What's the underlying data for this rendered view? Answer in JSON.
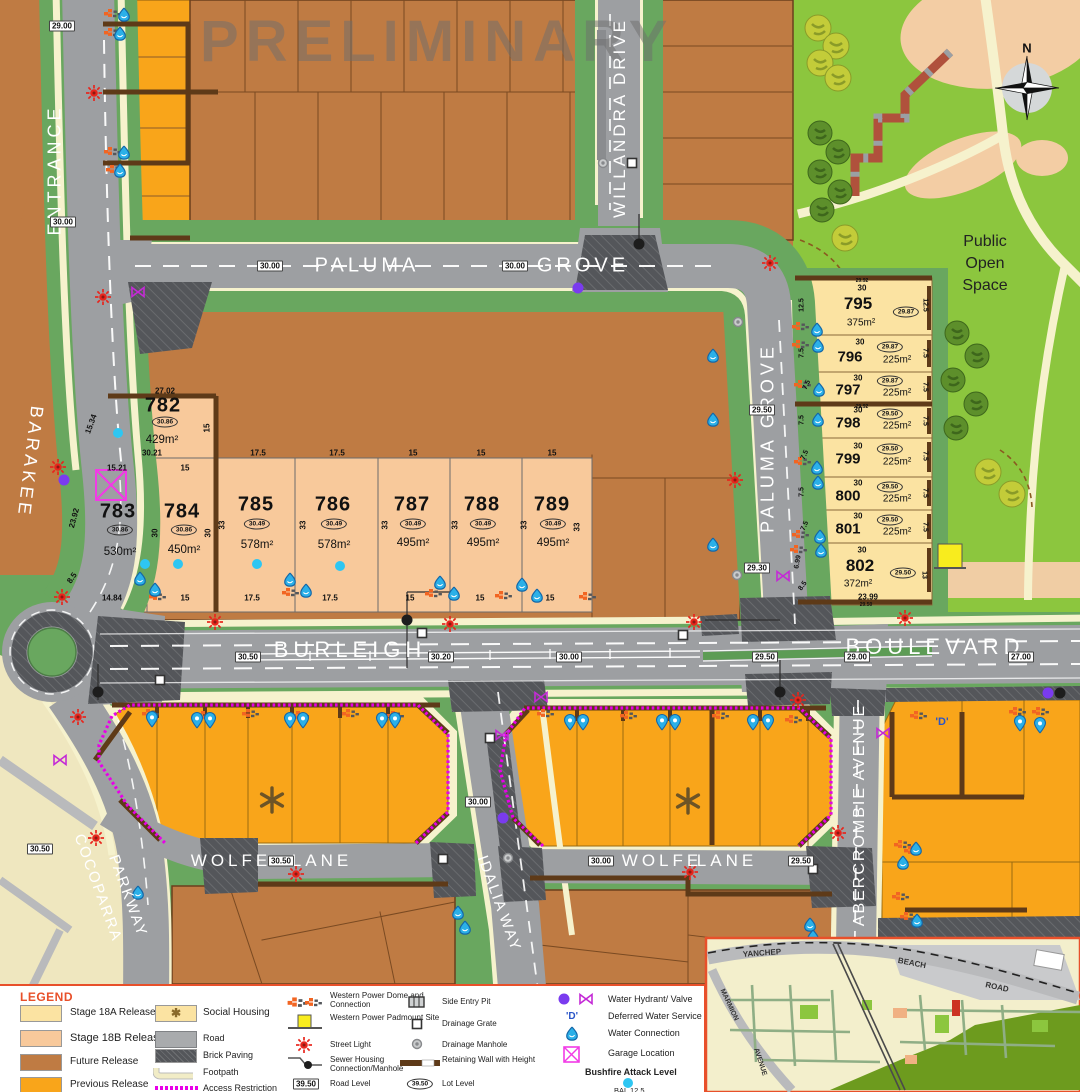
{
  "watermark": "PRELIMINARY",
  "map_labels": {
    "pos1": "Public",
    "pos2": "Open",
    "pos3": "Space",
    "north": "N",
    "deferred": "'D'"
  },
  "streets": {
    "entrance": "ENTRANCE",
    "barakee": "BARAKEE",
    "willandra": "WILLANDRA  DRIVE",
    "paluma_top": "PALUMA",
    "grove_top": "GROVE",
    "paluma_right": "PALUMA  GROVE",
    "burleigh": "BURLEIGH",
    "boulevard": "BOULEVARD",
    "wolfe_w1": "WOLFE",
    "wolfe_w2": "LANE",
    "wolfe_e1": "WOLFE",
    "wolfe_e2": "LANE",
    "idalia1": "IDALIA",
    "idalia2": "WAY",
    "abercrombie": "ABERCROMBIE  AVENUE",
    "cocoparra1": "COCOPARRA",
    "cocoparra2": "PARKWAY"
  },
  "road_levels": {
    "rl1": "29.00",
    "rl2": "30.00",
    "rl3": "30.00",
    "rl4": "30.00",
    "rl5": "29.50",
    "rl6": "29.30",
    "rl7": "30.50",
    "rl8": "30.20",
    "rl9": "30.00",
    "rl10": "29.50",
    "rl11": "29.00",
    "rl12": "27.00",
    "rl13": "30.50",
    "rl14": "30.50",
    "rl15": "30.00",
    "rl16": "29.50",
    "rl17": "30.00"
  },
  "wall_levels": {
    "a": "29.92",
    "b": "29.92",
    "c": "29.50"
  },
  "lots_18b": [
    {
      "num": "782",
      "level": "30.86",
      "area": "429m²",
      "top": "27.02",
      "left": "15.34",
      "right": "15",
      "bottom": "30.21"
    },
    {
      "num": "783",
      "level": "30.86",
      "area": "530m²",
      "top": "15.21",
      "left": "23.92",
      "left2": "8.5",
      "bottom": "14.84",
      "side": "30"
    },
    {
      "num": "784",
      "level": "30.86",
      "area": "450m²",
      "top": "15",
      "side": "30",
      "bottom": "15"
    },
    {
      "num": "785",
      "level": "30.49",
      "area": "578m²",
      "top": "17.5",
      "side": "33",
      "bottom": "17.5"
    },
    {
      "num": "786",
      "level": "30.49",
      "area": "578m²",
      "top": "17.5",
      "side": "33",
      "bottom": "17.5"
    },
    {
      "num": "787",
      "level": "30.49",
      "area": "495m²",
      "top": "15",
      "side": "33",
      "bottom": "15"
    },
    {
      "num": "788",
      "level": "30.49",
      "area": "495m²",
      "top": "15",
      "side": "33",
      "bottom": "15"
    },
    {
      "num": "789",
      "level": "30.49",
      "area": "495m²",
      "top": "15",
      "side": "33",
      "bottom": "15"
    }
  ],
  "lots_18a": [
    {
      "num": "795",
      "level": "29.87",
      "area": "375m²",
      "top": "30",
      "side": "12.5"
    },
    {
      "num": "796",
      "level": "29.87",
      "area": "225m²",
      "top": "30",
      "side": "7.5"
    },
    {
      "num": "797",
      "level": "29.87",
      "area": "225m²",
      "top": "30",
      "side": "7.5"
    },
    {
      "num": "798",
      "level": "29.50",
      "area": "225m²",
      "top": "30",
      "side": "7.5"
    },
    {
      "num": "799",
      "level": "29.50",
      "area": "225m²",
      "top": "30",
      "side": "7.5"
    },
    {
      "num": "800",
      "level": "29.50",
      "area": "225m²",
      "top": "30",
      "side": "7.5"
    },
    {
      "num": "801",
      "level": "29.50",
      "area": "225m²",
      "top": "30",
      "side": "7.5"
    },
    {
      "num": "802",
      "level": "29.50",
      "area": "372m²",
      "top": "30",
      "left": "6.99",
      "left2": "8.5",
      "right": "13",
      "bottom": "23.99"
    }
  ],
  "legend": {
    "title": "LEGEND",
    "releases": [
      {
        "label": "Stage 18A Release",
        "color": "#fbe3a2"
      },
      {
        "label": "Stage 18B Release",
        "color": "#f8c99b"
      },
      {
        "label": "Future Release",
        "color": "#bf7b43"
      },
      {
        "label": "Previous Release",
        "color": "#f9a51a"
      }
    ],
    "features": [
      {
        "label": "Social Housing"
      },
      {
        "label": "Road"
      },
      {
        "label": "Brick Paving"
      },
      {
        "label": "Footpath"
      },
      {
        "label": "Access Restriction"
      }
    ],
    "power": [
      {
        "label": "Western Power Dome and Connection"
      },
      {
        "label": "Western Power Padmount Site"
      },
      {
        "label": "Street Light"
      },
      {
        "label": "Sewer Housing Connection/Manhole"
      },
      {
        "label": "Road Level",
        "value": "39.50"
      }
    ],
    "drainage": [
      {
        "label": "Side Entry Pit"
      },
      {
        "label": "Drainage Grate"
      },
      {
        "label": "Drainage Manhole"
      },
      {
        "label": "Retaining Wall with Height"
      },
      {
        "label": "Lot Level",
        "value": "39.50"
      }
    ],
    "water": [
      {
        "label": "Water Hydrant/ Valve"
      },
      {
        "label": "Deferred Water Service",
        "prefix": "'D'"
      },
      {
        "label": "Water Connection"
      },
      {
        "label": "Garage Location"
      },
      {
        "label": "Bushfire Attack Level",
        "value": "BAL 12.5"
      }
    ]
  },
  "inset": {
    "yanchep": "YANCHEP",
    "beach": "BEACH",
    "road": "ROAD",
    "marmion": "MARMION",
    "avenue": "AVENUE"
  }
}
